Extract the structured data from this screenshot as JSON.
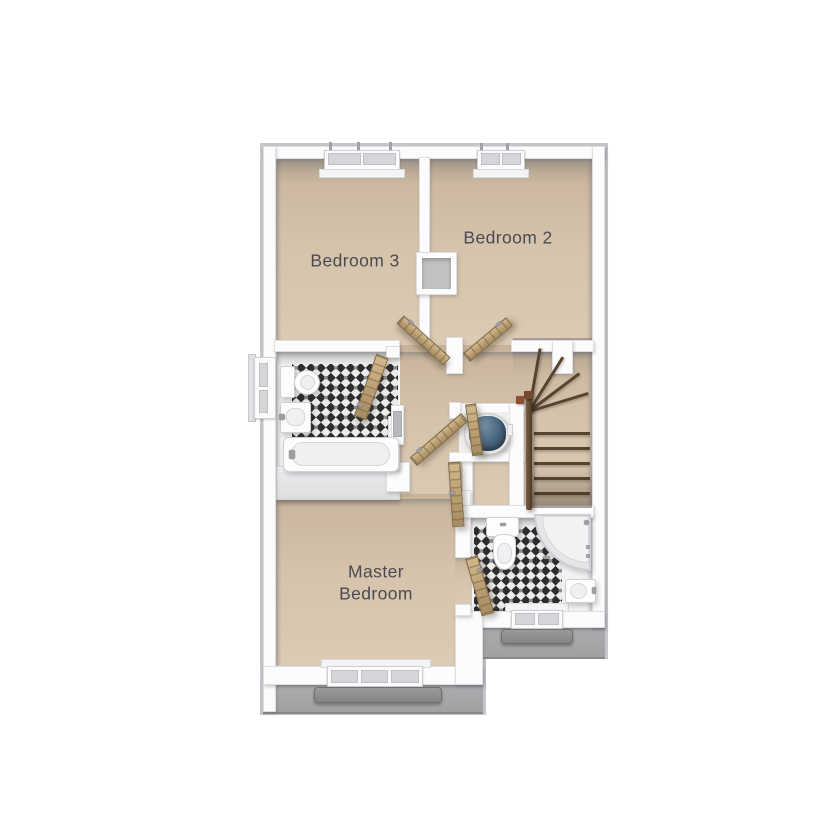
{
  "floorplan": {
    "rooms": [
      {
        "id": "bedroom3",
        "label": "Bedroom 3"
      },
      {
        "id": "bedroom2",
        "label": "Bedroom 2"
      },
      {
        "id": "master_bedroom",
        "label_line1": "Master",
        "label_line2": "Bedroom"
      }
    ],
    "palette": {
      "floor_beige": "#d6c4ac",
      "wall_white": "#fcfcfd",
      "exterior_ledge_gray": "#a2a2a4",
      "tile_dark": "#2d2d30",
      "tile_light": "#ecece9",
      "door_wood": "#bda379",
      "stair_rail_wood": "#5d4733",
      "water_tank_blue": "#46637d",
      "label_text": "#4b4a52"
    }
  }
}
